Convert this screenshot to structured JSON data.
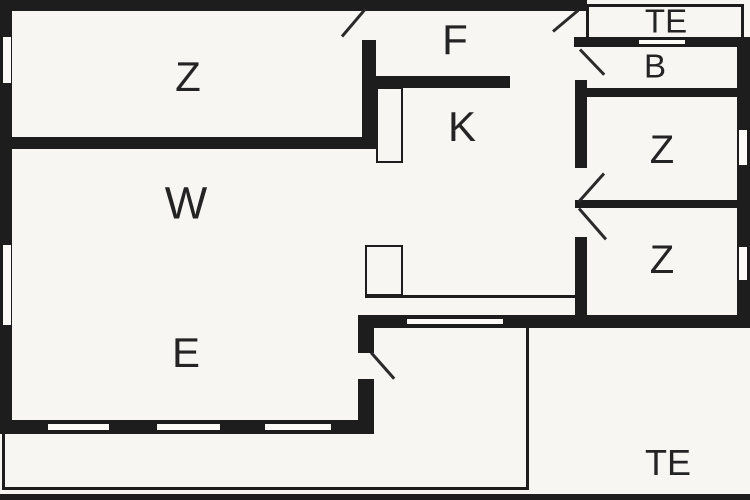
{
  "plan_type": "floor-plan",
  "colors": {
    "background": "#f7f6f2",
    "wall": "#1d1d1d",
    "label": "#242424"
  },
  "rooms": [
    {
      "id": "room-z-top-left",
      "label": "Z"
    },
    {
      "id": "room-f-corridor",
      "label": "F"
    },
    {
      "id": "room-k-kitchen",
      "label": "K"
    },
    {
      "id": "terrace-top",
      "label": "TE"
    },
    {
      "id": "room-b-bath",
      "label": "B"
    },
    {
      "id": "room-z-right-upper",
      "label": "Z"
    },
    {
      "id": "room-z-right-lower",
      "label": "Z"
    },
    {
      "id": "room-w-living",
      "label": "W"
    },
    {
      "id": "room-e-dining",
      "label": "E"
    },
    {
      "id": "terrace-bottom",
      "label": "TE"
    }
  ]
}
